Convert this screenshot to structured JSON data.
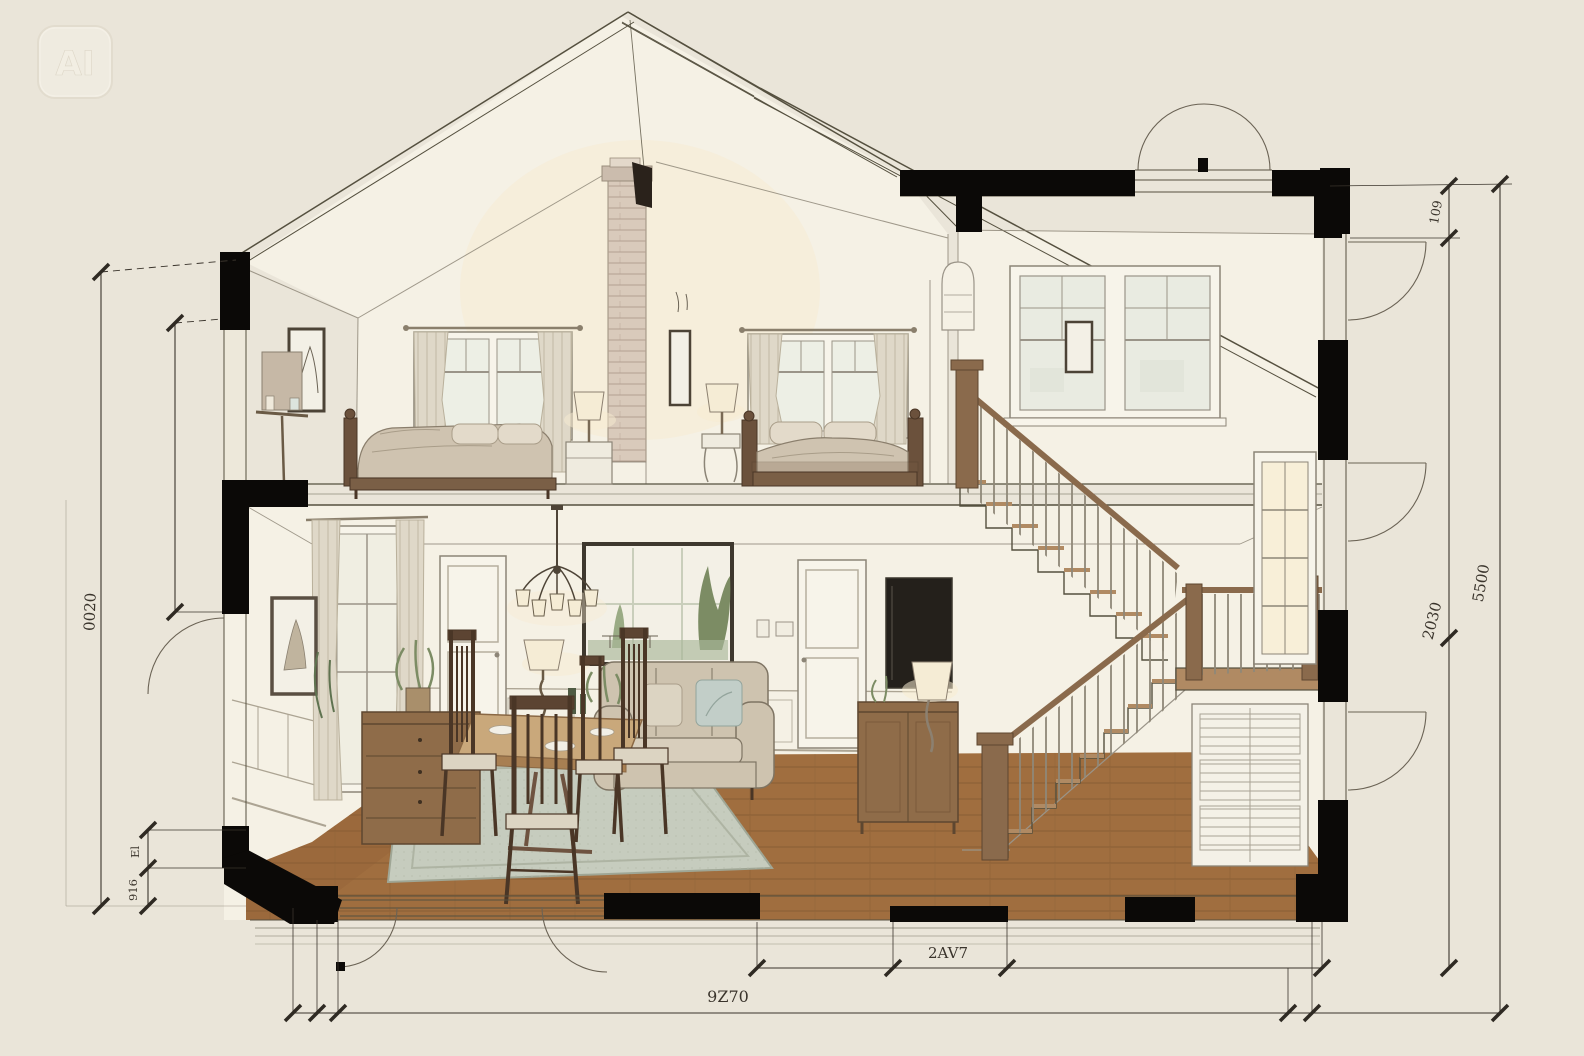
{
  "watermark": {
    "label": "AI"
  },
  "dimensions": {
    "left_outer": "0020",
    "left_step_upper": "El",
    "left_step_lower": "916",
    "right_top": "109",
    "right_mid": "2030",
    "right_outer": "5500",
    "bottom_inner": "2AV7",
    "bottom_outer": "9Z70"
  },
  "palette": {
    "paper": "#EAE5D9",
    "ink": "#55503F",
    "cut": "#0B0907",
    "wall": "#F5F1E5",
    "glow": "#F7ECD2",
    "wood": "#A06E3F",
    "tread": "#B08A63",
    "furnwood": "#8F6C49",
    "sofa": "#CEC3AF",
    "duvet": "#CFC3B0",
    "curtain": "#DFD8C8",
    "rug": "#C6CCBE",
    "brick": "#D9CABB",
    "lampshade": "#F5ECD5",
    "dim": "#3A342C"
  }
}
